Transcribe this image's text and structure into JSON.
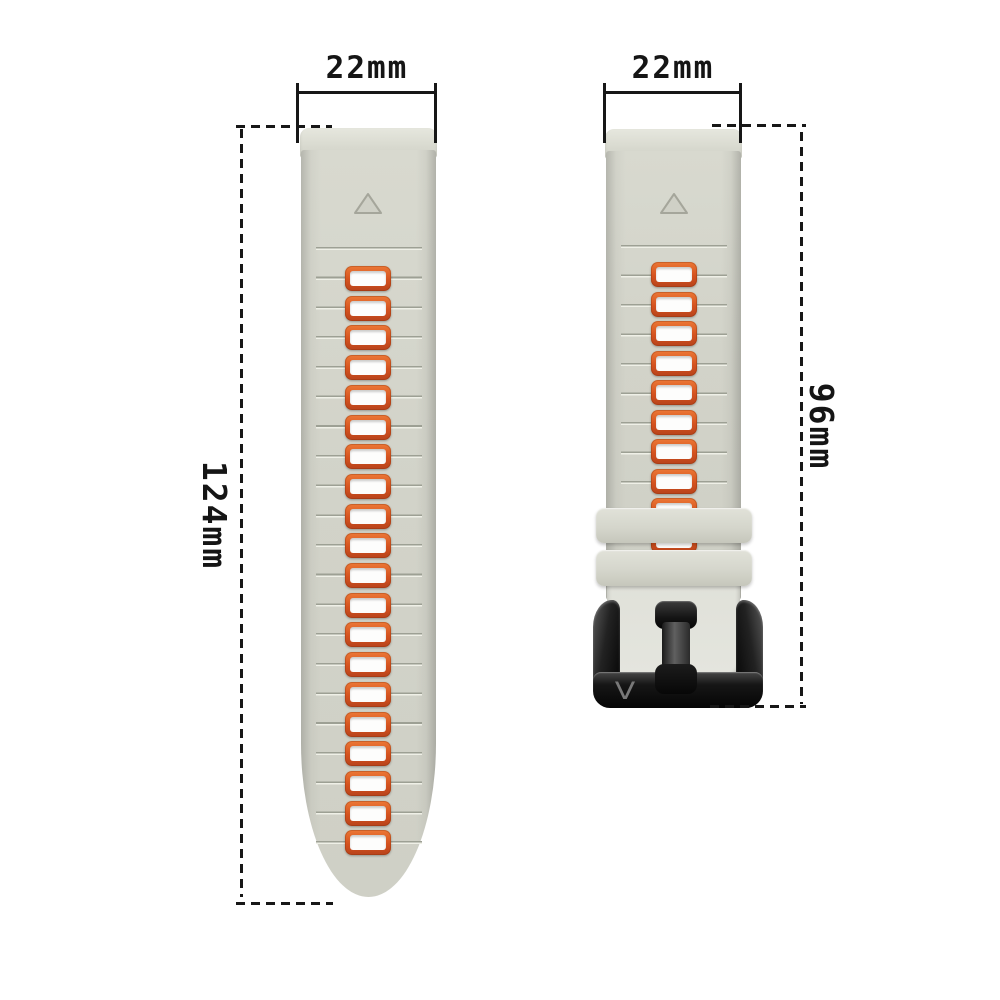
{
  "annotations": {
    "long_strap": {
      "width_label": "22mm",
      "length_label": "124mm"
    },
    "short_strap": {
      "width_label": "22mm",
      "length_label": "96mm"
    }
  },
  "long_strap": {
    "slot_count": 20,
    "has_triangle_marker": true
  },
  "short_strap": {
    "slot_count": 10,
    "keeper_count": 2,
    "has_triangle_marker": true,
    "buckle_logo_text": "V"
  },
  "colors": {
    "background": "#ffffff",
    "strap_gray": "#d2d3c9",
    "strap_cap_gray": "#e0e1d8",
    "slot_ring_orange": "#d4521f",
    "slot_inner_white": "#fdfdfc",
    "groove_line": "#9da094",
    "keeper_gray": "#d5d6cc",
    "buckle_black": "#141414",
    "dimension_line_black": "#171717"
  }
}
